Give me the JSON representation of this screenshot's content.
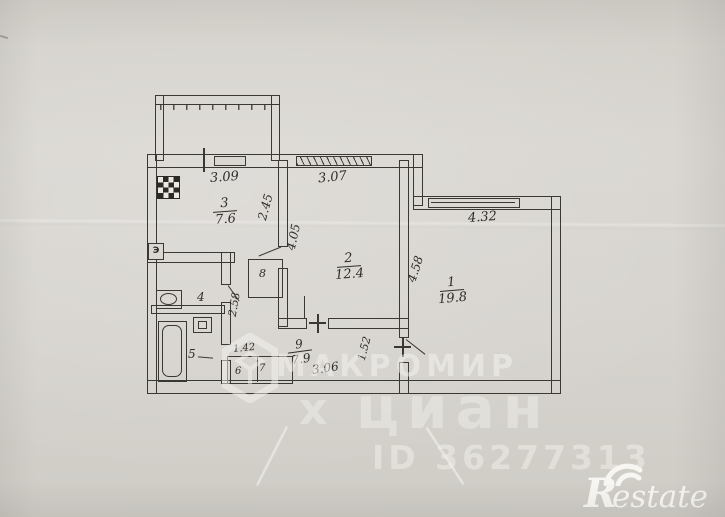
{
  "watermarks": {
    "agency": "МАКРОМИР",
    "portal": "циан",
    "portal_mark": "х",
    "listing_id": "ID 36277313",
    "brand_initial": "R",
    "brand_rest": "estate"
  },
  "symbols": {
    "electrical_panel": "Э"
  },
  "rooms": {
    "r1": {
      "number": "1",
      "area": "19.8"
    },
    "r2": {
      "number": "2",
      "area": "12.4"
    },
    "r3": {
      "number": "3",
      "area": "7.6"
    },
    "r4": {
      "number": "4"
    },
    "r5": {
      "number": "5"
    },
    "r6": {
      "number": "6"
    },
    "r7": {
      "number": "7"
    },
    "r8": {
      "number": "8"
    },
    "r9": {
      "number": "9",
      "area": "7.9"
    }
  },
  "dimensions": {
    "kitchen_width": "3.09",
    "room2_width": "3.07",
    "room1_width": "4.32",
    "kitchen_depth": "2.45",
    "room2_depth": "4.05",
    "room1_depth": "4.58",
    "bathroom_depth": "2.58",
    "closet_width": "1.42",
    "hall_depth": "1.52",
    "hall_width": "3.06"
  }
}
